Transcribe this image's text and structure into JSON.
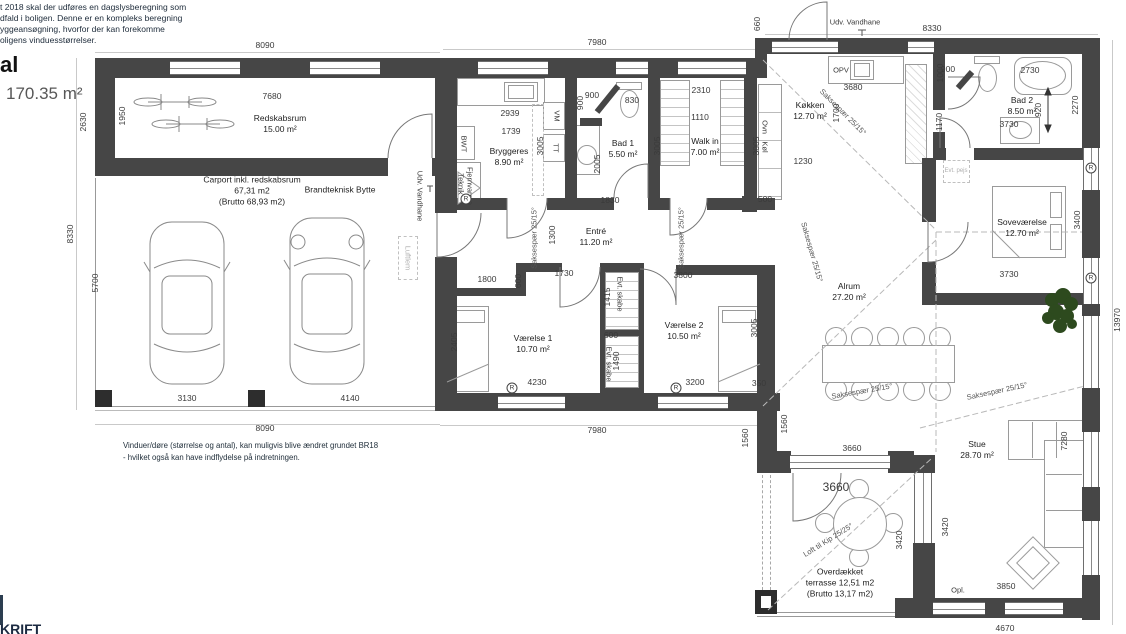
{
  "header": {
    "note_lines": [
      "t 2018 skal der udføres en dagslysberegning som",
      "dfald i boligen. Denne er en kompleks beregning",
      "yggeansøgning, hvorfor der kan forekomme",
      "oligens vinduesstørrelser."
    ],
    "title_fragment": "al",
    "total_area": "170.35 m²"
  },
  "footer": {
    "note_line1": "Vinduer/døre (størrelse og antal), kan muligvis blive ændret grundet BR18",
    "note_line2": "- hvilket også kan have indflydelse på indretningen.",
    "logo_fragment": "KRIFT"
  },
  "rooms": {
    "redskabsrum": {
      "name": "Redskabsrum",
      "area": "15.00 m²"
    },
    "carport": {
      "line1": "Carport inkl. redskabsrum",
      "line2": "67,31 m2",
      "line3": "(Brutto 68,93 m2)"
    },
    "brandteknisk": {
      "name": "Brandteknisk Bytte"
    },
    "bryggers": {
      "name": "Bryggeres",
      "area": "8.90 m²"
    },
    "bad1": {
      "name": "Bad 1",
      "area": "5.50 m²"
    },
    "walkin": {
      "name": "Walk in",
      "area": "7.00 m²"
    },
    "entre": {
      "name": "Entré",
      "area": "11.20 m²"
    },
    "koekken": {
      "name": "Køkken",
      "area": "12.70 m²"
    },
    "bad2": {
      "name": "Bad 2",
      "area": "8.50 m²"
    },
    "sovevaerelse": {
      "name": "Soveværelse",
      "area": "12.70 m²"
    },
    "alrum": {
      "name": "Alrum",
      "area": "27.20 m²"
    },
    "vaerelse1": {
      "name": "Værelse 1",
      "area": "10.70 m²"
    },
    "vaerelse2": {
      "name": "Værelse 2",
      "area": "10.50 m²"
    },
    "stue": {
      "name": "Stue",
      "area": "28.70 m²"
    },
    "terrasse": {
      "line1": "Overdækket",
      "line2": "terrasse 12,51 m2",
      "line3": "(Brutto 13,17 m2)"
    }
  },
  "labels": {
    "udv_vandhane": "Udv. Vandhane",
    "opv": "OPV",
    "vm": "VM",
    "tt": "TT",
    "bwt": "BWT",
    "teknik": "Teknik",
    "fjernvarme": "Fjernvarme",
    "ovn": "Ovn",
    "koel": "Køl",
    "luftlem": "Luftlem",
    "evt_skabe": "Evt. skabe",
    "opl": "Opl.",
    "evt_pejs": "Evt. pejs",
    "saksespaer": "Saksespær 25/15°",
    "loft_til_kip": "Loft til Kip 25/25°",
    "r_mark": "R"
  },
  "dims": {
    "d8090": "8090",
    "d7980": "7980",
    "d8330": "8330",
    "d660": "660",
    "d7680": "7680",
    "d1950": "1950",
    "d2630": "2630",
    "d5700": "5700",
    "d2939": "2939",
    "d1739": "1739",
    "d3005": "3005",
    "d900": "900",
    "d830": "830",
    "d2005": "2005",
    "d1830": "1830",
    "d2310": "2310",
    "d1110": "1110",
    "d3680": "3680",
    "d2730": "2730",
    "d1000": "1000",
    "d920": "920",
    "d2270": "2270",
    "d1170": "1170",
    "d3730": "3730",
    "d1700": "1700",
    "d1230": "1230",
    "d500": "500",
    "d1800": "1800",
    "d600": "600",
    "d1730": "1730",
    "d1300": "1300",
    "d2405": "2405",
    "d4230": "4230",
    "d1415": "1415",
    "d1490": "1490",
    "d3800": "3800",
    "d3200": "3200",
    "d350": "350",
    "d3400": "3400",
    "d13970": "13970",
    "d3130": "3130",
    "d4140": "4140",
    "d3660": "3660",
    "d3420": "3420",
    "d1560": "1560",
    "d7280": "7280",
    "d3850": "3850",
    "d4670": "4670"
  },
  "colors": {
    "wall": "#464646",
    "dim_text": "#3a3a3a",
    "grey_label": "#b0b0b0",
    "note_text": "#1d2b3a"
  }
}
